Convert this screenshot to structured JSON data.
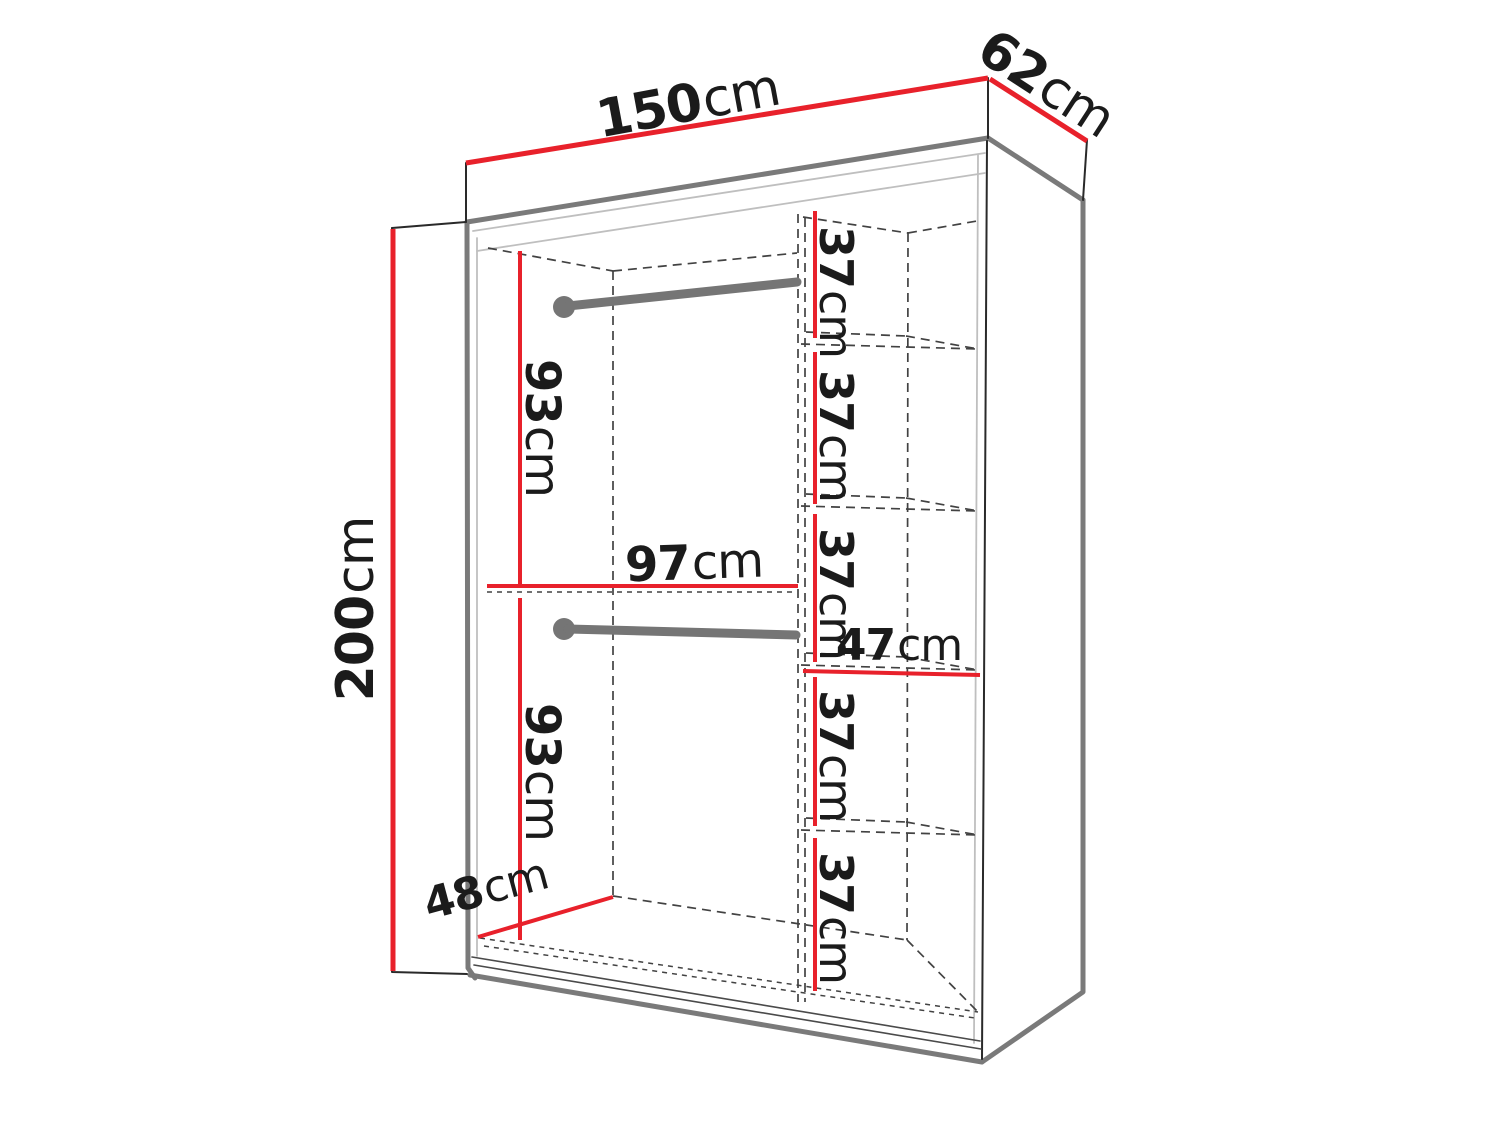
{
  "diagram_type": "wardrobe-dimension-diagram",
  "colors": {
    "dimension_line": "#e8212b",
    "outline_thick": "#7a7a7a",
    "outline_thin": "#2a2a2a",
    "dashed_line": "#424242",
    "light_line": "#bfbfbf",
    "rail": "#757575",
    "label_text": "#1b1b1b",
    "background": "#ffffff"
  },
  "dims": {
    "width": {
      "value": "150",
      "unit": "cm"
    },
    "depth": {
      "value": "62",
      "unit": "cm"
    },
    "height": {
      "value": "200",
      "unit": "cm"
    },
    "upper_hanging_height": {
      "value": "93",
      "unit": "cm"
    },
    "lower_hanging_height": {
      "value": "93",
      "unit": "cm"
    },
    "hanging_section_width": {
      "value": "97",
      "unit": "cm"
    },
    "interior_depth": {
      "value": "48",
      "unit": "cm"
    },
    "shelf_section_width": {
      "value": "47",
      "unit": "cm"
    },
    "shelf_gaps": [
      {
        "value": "37",
        "unit": "cm"
      },
      {
        "value": "37",
        "unit": "cm"
      },
      {
        "value": "37",
        "unit": "cm"
      },
      {
        "value": "37",
        "unit": "cm"
      },
      {
        "value": "37",
        "unit": "cm"
      }
    ]
  }
}
